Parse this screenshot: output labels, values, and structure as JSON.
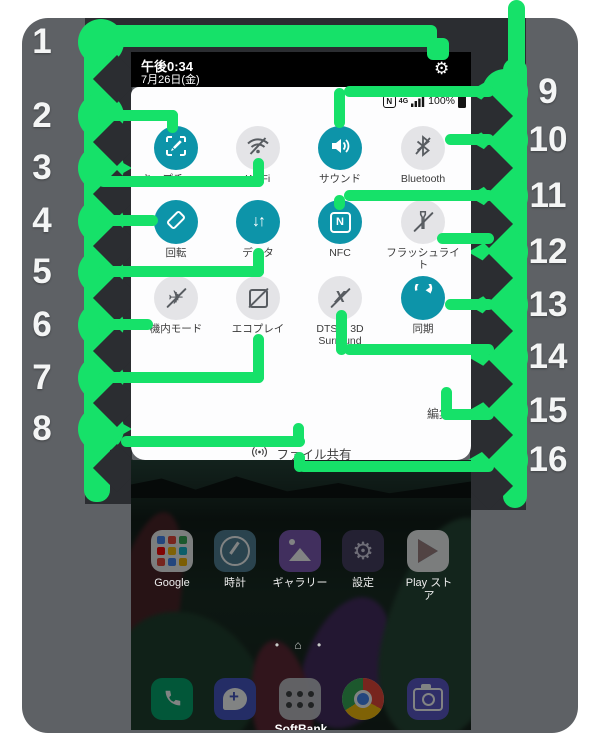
{
  "callout_numbers": {
    "left": [
      "1",
      "2",
      "3",
      "4",
      "5",
      "6",
      "7",
      "8"
    ],
    "right": [
      "9",
      "10",
      "11",
      "12",
      "13",
      "14",
      "15",
      "16"
    ]
  },
  "status_bar": {
    "time": "午後0:34",
    "date": "7月26日(金)",
    "battery": "100%",
    "network": "4G"
  },
  "quick_settings": {
    "tiles": [
      {
        "label": "キャプチャー+",
        "state": "on",
        "icon": "capture-plus-icon"
      },
      {
        "label": "Wi-Fi",
        "state": "off",
        "icon": "wifi-off-icon"
      },
      {
        "label": "サウンド",
        "state": "on",
        "icon": "sound-icon"
      },
      {
        "label": "Bluetooth",
        "state": "off",
        "icon": "bluetooth-off-icon"
      },
      {
        "label": "回転",
        "state": "on",
        "icon": "rotation-icon"
      },
      {
        "label": "データ",
        "state": "on",
        "icon": "mobile-data-icon"
      },
      {
        "label": "NFC",
        "state": "on",
        "icon": "nfc-icon"
      },
      {
        "label": "フラッシュライト",
        "state": "off",
        "icon": "flashlight-off-icon"
      },
      {
        "label": "機内モード",
        "state": "off",
        "icon": "airplane-mode-icon"
      },
      {
        "label": "エコプレイ",
        "state": "off",
        "icon": "eco-play-icon"
      },
      {
        "label": "DTS:X 3D Surround",
        "state": "off",
        "icon": "dts-3d-surround-icon"
      },
      {
        "label": "同期",
        "state": "on",
        "icon": "sync-icon"
      }
    ],
    "edit_label": "編集",
    "file_share_label": "ファイル共有",
    "nfc_glyph": "N",
    "data_glyph": "↓↑",
    "dts_glyph": "X",
    "airplane_glyph": "✈",
    "gear_glyph": "⚙"
  },
  "home_screen": {
    "apps": [
      {
        "label": "Google"
      },
      {
        "label": "時計"
      },
      {
        "label": "ギャラリー"
      },
      {
        "label": "設定"
      },
      {
        "label": "Play ストア"
      }
    ],
    "dock_label": "SoftBank",
    "page_indicator": "•  ⌂  •"
  },
  "colors": {
    "accent_green": "#16e169",
    "tile_active_teal": "#0d94a9",
    "tile_inactive_gray": "#e4e4e7",
    "frame_gray": "#5e6165",
    "charcoal": "#2b2d31"
  }
}
